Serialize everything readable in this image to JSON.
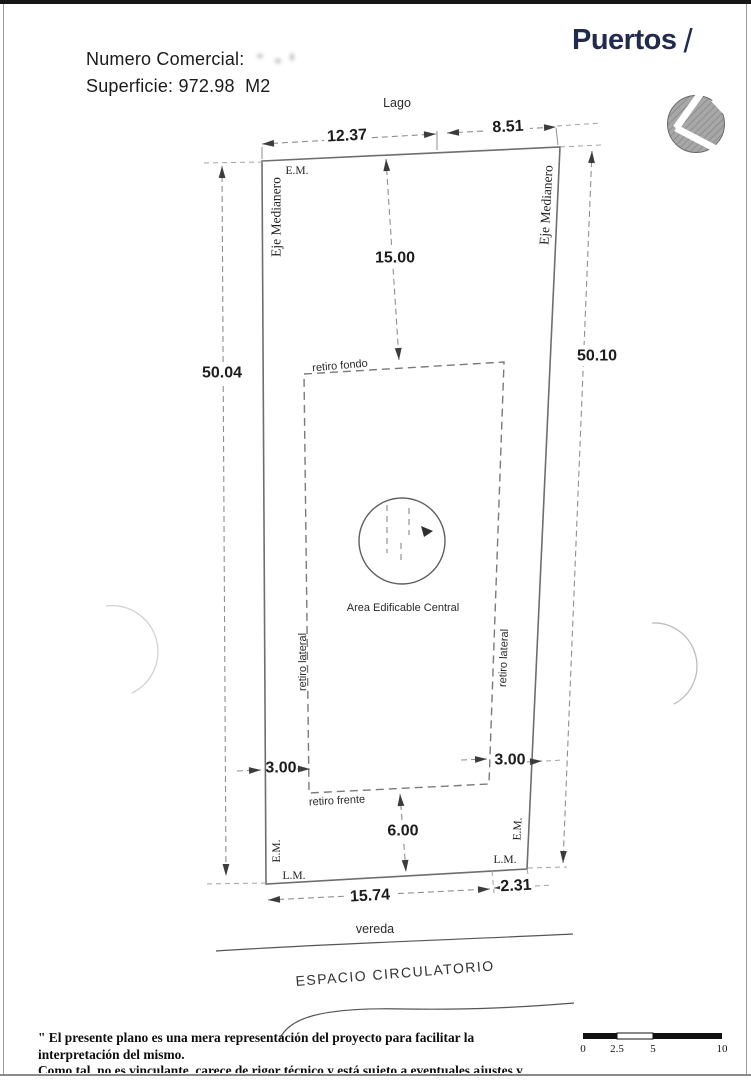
{
  "header": {
    "numero_comercial_label": "Numero Comercial:",
    "superficie_line": "Superficie: 972.98  M2"
  },
  "logo": {
    "name": "Puertos",
    "slash": "/"
  },
  "plan": {
    "lago_label": "Lago",
    "top_dims": {
      "left": "12.37",
      "right": "8.51"
    },
    "depth_dim": "15.00",
    "side_dims": {
      "left": "50.04",
      "right": "50.10"
    },
    "em_top_left": "E.M.",
    "eje_medianero_left": "Eje Medianero",
    "eje_medianero_right": "Eje Medianero",
    "envelope": {
      "retiro_fondo": "retiro fondo",
      "retiro_lateral_left": "retiro lateral",
      "retiro_lateral_right": "retiro lateral",
      "retiro_frente": "retiro frente",
      "area_label": "Area Edificable Central",
      "lateral_dim_left": "3.00",
      "lateral_dim_right": "3.00",
      "frente_dim": "6.00"
    },
    "bottom": {
      "em_left": "E.M.",
      "em_right": "E.M.",
      "lm_left": "L.M.",
      "lm_right": "L.M.",
      "front_dims": {
        "left": "15.74",
        "right": "2.31"
      },
      "vereda_label": "vereda",
      "espacio_label": "ESPACIO CIRCULATORIO"
    }
  },
  "scale_bar": {
    "ticks": [
      "0",
      "2.5",
      "5",
      "10"
    ]
  },
  "disclaimer": {
    "line1": "\" El presente plano es una mera representación del proyecto para facilitar la interpretación del mismo.",
    "line2": "Como tal, no es vinculante, carece de rigor técnico y está sujeto a eventuales ajustes y modificaciones, y las",
    "line3": "medidas definitivas serán las que resulten de la aprobación de los organismos Nacionales, Provinciales y Municipales.\""
  },
  "colors": {
    "logo_navy": "#222b4e",
    "line_gray": "#6e6e6e",
    "dash_gray": "#8f8f8f"
  }
}
